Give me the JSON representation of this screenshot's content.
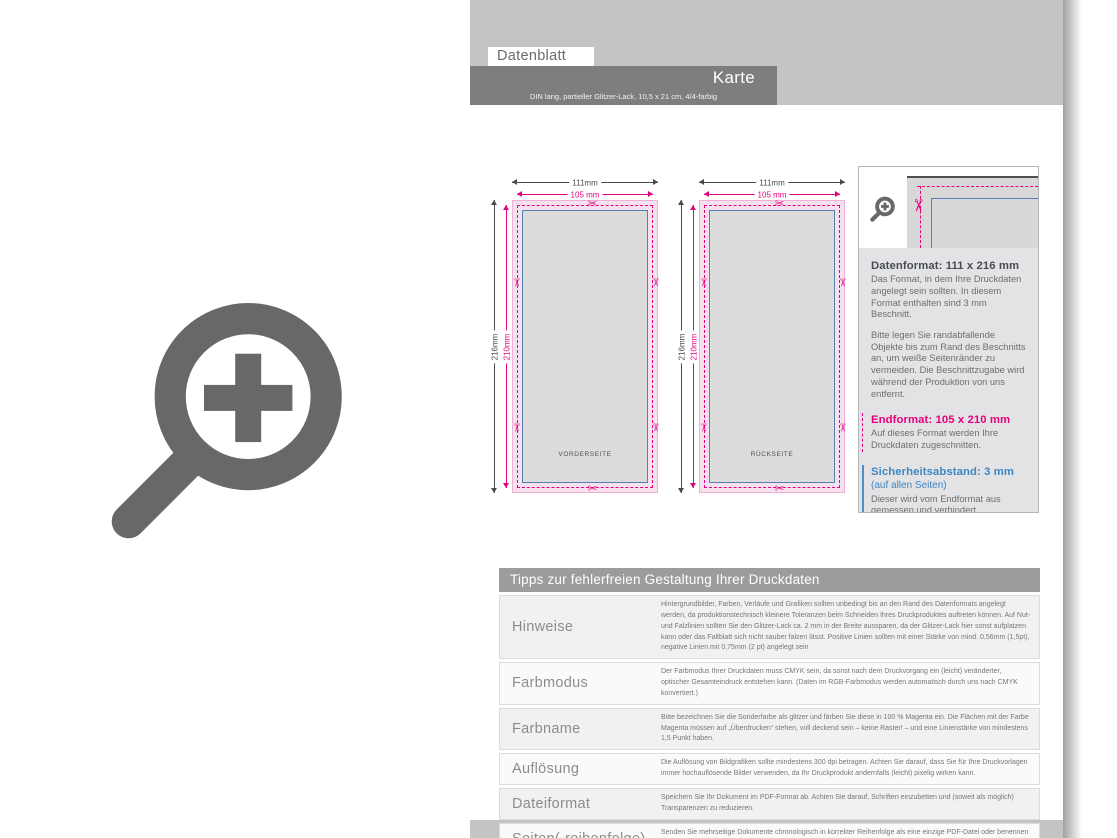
{
  "header": {
    "tab_label": "Datenblatt",
    "title": "Karte",
    "subtitle": "DIN lang, partieller Glitzer-Lack, 10,5 x 21 cm, 4/4-farbig"
  },
  "diagram": {
    "width_outer_label": "111mm",
    "width_trim_label": "105 mm",
    "height_outer_label": "216mm",
    "height_trim_label": "210mm",
    "front_label": "VORDERSEITE",
    "back_label": "RÜCKSEITE"
  },
  "info_box": {
    "datenformat": {
      "heading": "Datenformat: 111 x 216 mm",
      "p1": "Das Format, in dem Ihre Druckdaten angelegt sein sollten. In diesem Format enthalten sind 3 mm Beschnitt.",
      "p2": "Bitte legen Sie randabfallende Objekte bis zum Rand des Beschnitts an, um weiße Seitenränder zu vermeiden. Die Beschnittzugabe wird während der Produktion von uns entfernt."
    },
    "endformat": {
      "heading": "Endformat: 105 x 210 mm",
      "p1": "Auf dieses Format werden Ihre Druckdaten zugeschnitten."
    },
    "sicherheitsabstand": {
      "heading": "Sicherheitsabstand: 3 mm",
      "subheading": "(auf allen Seiten)",
      "p1": "Dieser wird vom Endformat aus gemessen und verhindert unerwünschten Anschnitt Ihrer Texte und Informationen während der Produktion."
    }
  },
  "tips": {
    "title": "Tipps zur fehlerfreien Gestaltung Ihrer Druckdaten",
    "rows": [
      {
        "label": "Hinweise",
        "text": "Hintergrundbilder, Farben, Verläufe und Grafiken sollten unbedingt bis an den Rand des Datenformats angelegt werden, da produktionstechnisch kleinere Toleranzen beim Schneiden Ihres Druckproduktes auftreten können. Auf Nut- und Falzlinien sollten Sie den Glitzer-Lack ca. 2 mm in der Breite aussparen, da der Glitzer-Lack hier sonst aufplatzen kann oder das Faltblatt sich nicht sauber falzen lässt. Positive Linien sollten mit einer Stärke von mind. 0,56mm (1,5pt), negative Linien mit 0,75mm (2 pt) angelegt sein"
      },
      {
        "label": "Farbmodus",
        "text": "Der Farbmodus Ihrer Druckdaten muss CMYK sein, da sonst nach dem Druckvorgang ein (leicht) veränderter, optischer Gesamteindruck entstehen kann. (Daten im RGB-Farbmodus werden automatisch durch uns nach CMYK konvertiert.)"
      },
      {
        "label": "Farbname",
        "text": "Bitte bezeichnen Sie die Sonderfarbe als glitzer und färben Sie diese in 100 % Magenta ein. Die Flächen mit der Farbe Magenta müssen auf „Überdrucken“ stehen, voll deckend sein – keine Raster! – und eine Linienstärke von mindestens 1,5 Punkt haben."
      },
      {
        "label": "Auflösung",
        "text": "Die Auflösung von Bildgrafiken sollte mindestens 300 dpi betragen. Achten Sie darauf, dass Sie für Ihre Druckvorlagen immer hochauflösende Bilder verwenden, da Ihr Druckprodukt andernfalls (leicht) pixelig wirken kann."
      },
      {
        "label": "Dateiformat",
        "text": "Speichern Sie Ihr Dokument im PDF-Format ab. Achten Sie darauf, Schriften einzubetten und (soweit als möglich) Transparenzen zu reduzieren."
      },
      {
        "label": "Seiten(-reihenfolge)",
        "text": "Senden Sie mehrseitige Dokumente chronologisch in korrekter Reihenfolge als eine einzige PDF-Datei oder benennen Sie Einzeldokumente entsprechend mit fortlaufenden Seitennummern."
      }
    ]
  },
  "icons": {
    "scissors": "✂"
  },
  "colors": {
    "magenta": "#e5007d",
    "blue": "#4a90c4",
    "dim_dark": "#4a4a4a",
    "band_gray": "#c4c4c4",
    "bar_gray": "#7e7e7e",
    "icon_gray": "#686868"
  }
}
